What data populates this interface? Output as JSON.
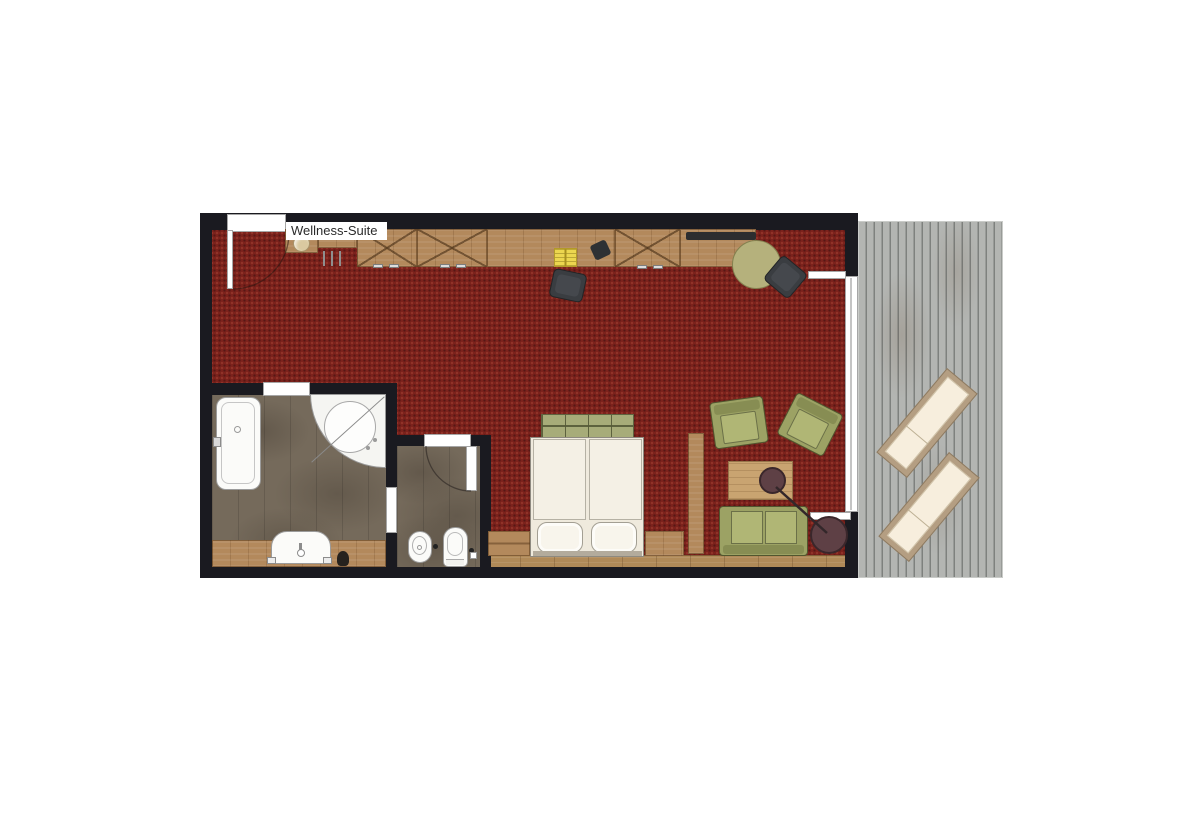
{
  "floorplan": {
    "title": "Wellness-Suite",
    "areas": [
      "living-bedroom",
      "bathroom",
      "wc",
      "balcony-terrace"
    ],
    "objects": [
      "entrance-door",
      "wardrobe-sideboard",
      "decor-bowl",
      "coat-hooks",
      "notepad",
      "telephone",
      "desk-chair",
      "flatscreen-tv",
      "round-table",
      "side-chair",
      "balcony-glass-front",
      "balcony-door-leaf-upper",
      "balcony-door-leaf-lower",
      "double-bed",
      "foot-bench",
      "pillow-left",
      "pillow-right",
      "nightstand-left",
      "nightstand-right",
      "room-divider",
      "armchair-left",
      "armchair-right",
      "coffee-table",
      "decor-tray",
      "floor-lamp",
      "two-seat-sofa",
      "bathtub",
      "corner-whirlpool-tub",
      "vanity-washbasin",
      "bidet",
      "toilet",
      "bathroom-door",
      "wc-door",
      "connecting-opening",
      "sun-lounger-1",
      "sun-lounger-2",
      "wood-deck"
    ]
  },
  "palette": {
    "carpet_red": "#7b221c",
    "wall_black": "#1a1a20",
    "wood_mid": "#b3895c",
    "wood_light": "#c9a471",
    "olive_green": "#9ca264",
    "bench_green": "#a7ac79",
    "deck_gray": "#b3b5b2",
    "mauve_accent": "#5e4045",
    "bath_floor_brown": "#756a5b",
    "linen_white": "#f4f0e5",
    "notepad_yellow": "#ecd64f"
  }
}
